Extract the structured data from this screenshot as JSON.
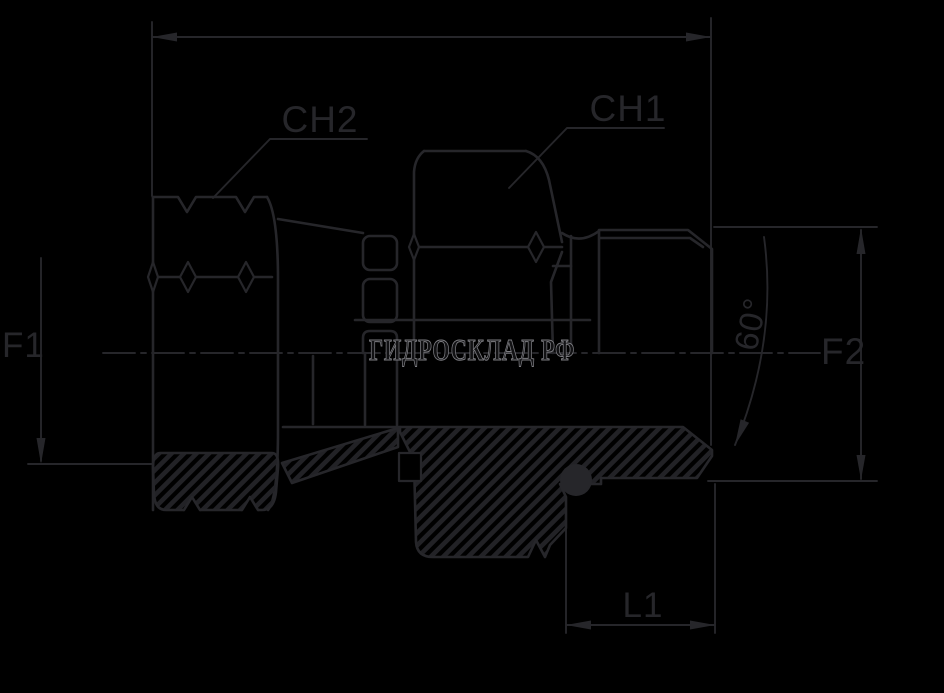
{
  "drawing": {
    "kind": "hydraulic-adapter-fitting-cross-section",
    "labels": {
      "ch2": "CH2",
      "ch1": "CH1",
      "f1": "F1",
      "f2": "F2",
      "l1": "L1",
      "angle": "60°"
    },
    "watermark": {
      "text": "ГИДРОСКЛАД РФ"
    }
  },
  "colors": {
    "background": "#000000",
    "line": "#26262a",
    "hatch": "#222226",
    "watermark_stroke": "#7c7c81",
    "watermark_fill": "#121214"
  }
}
